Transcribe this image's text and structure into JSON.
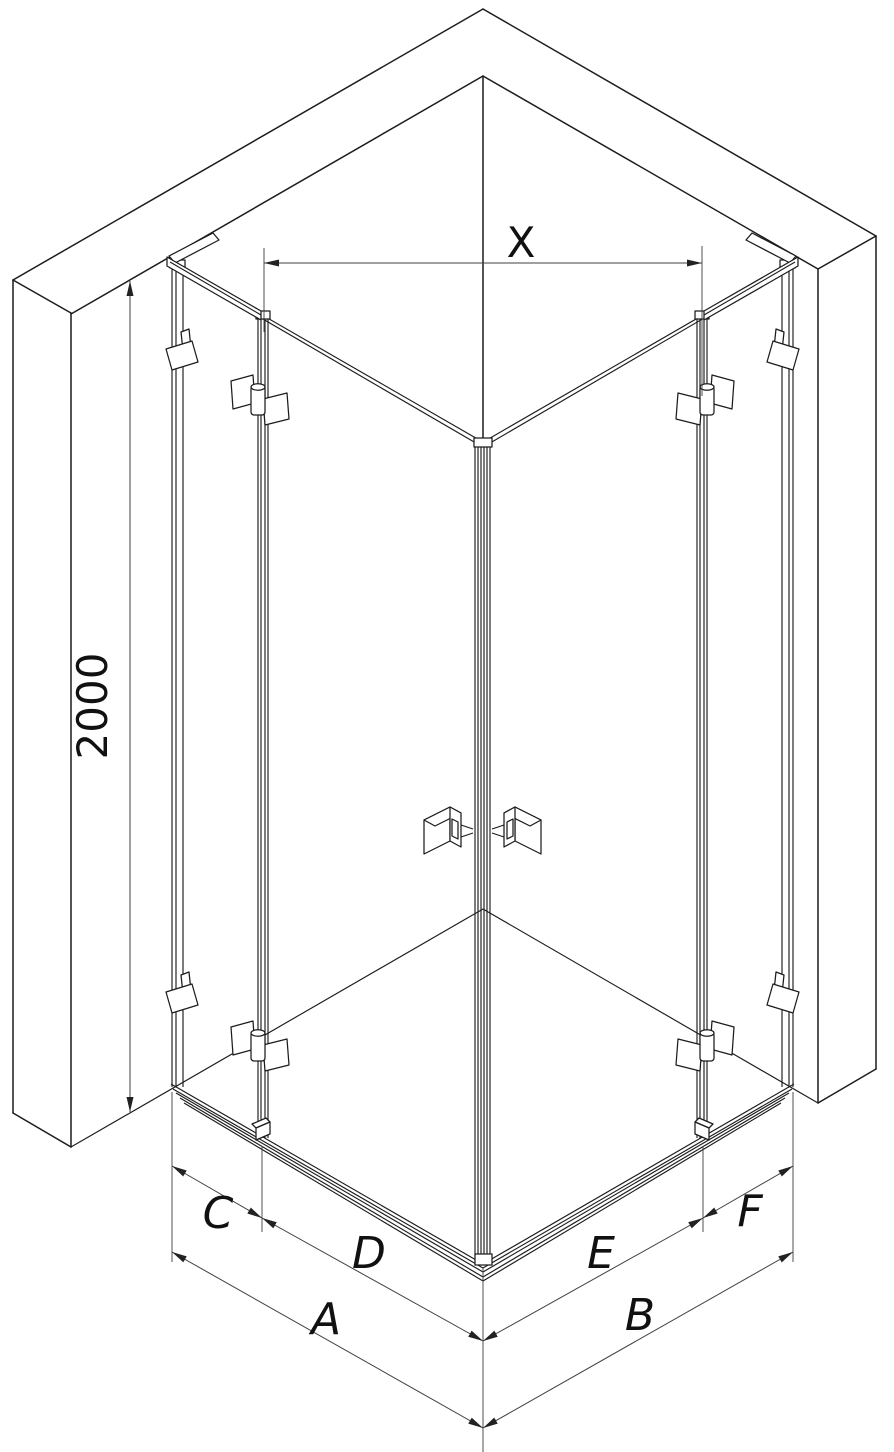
{
  "diagram": {
    "background_color": "#ffffff",
    "line_color": "#1c1c1c",
    "dimension_color": "#3f3f3f",
    "labels": {
      "width_top": "X",
      "height_left": "2000",
      "left_wall_to_hinge": "C",
      "left_hinge_to_corner": "D",
      "left_overall": "A",
      "right_hinge_to_corner": "E",
      "right_wall_to_hinge": "F",
      "right_overall": "B"
    }
  }
}
